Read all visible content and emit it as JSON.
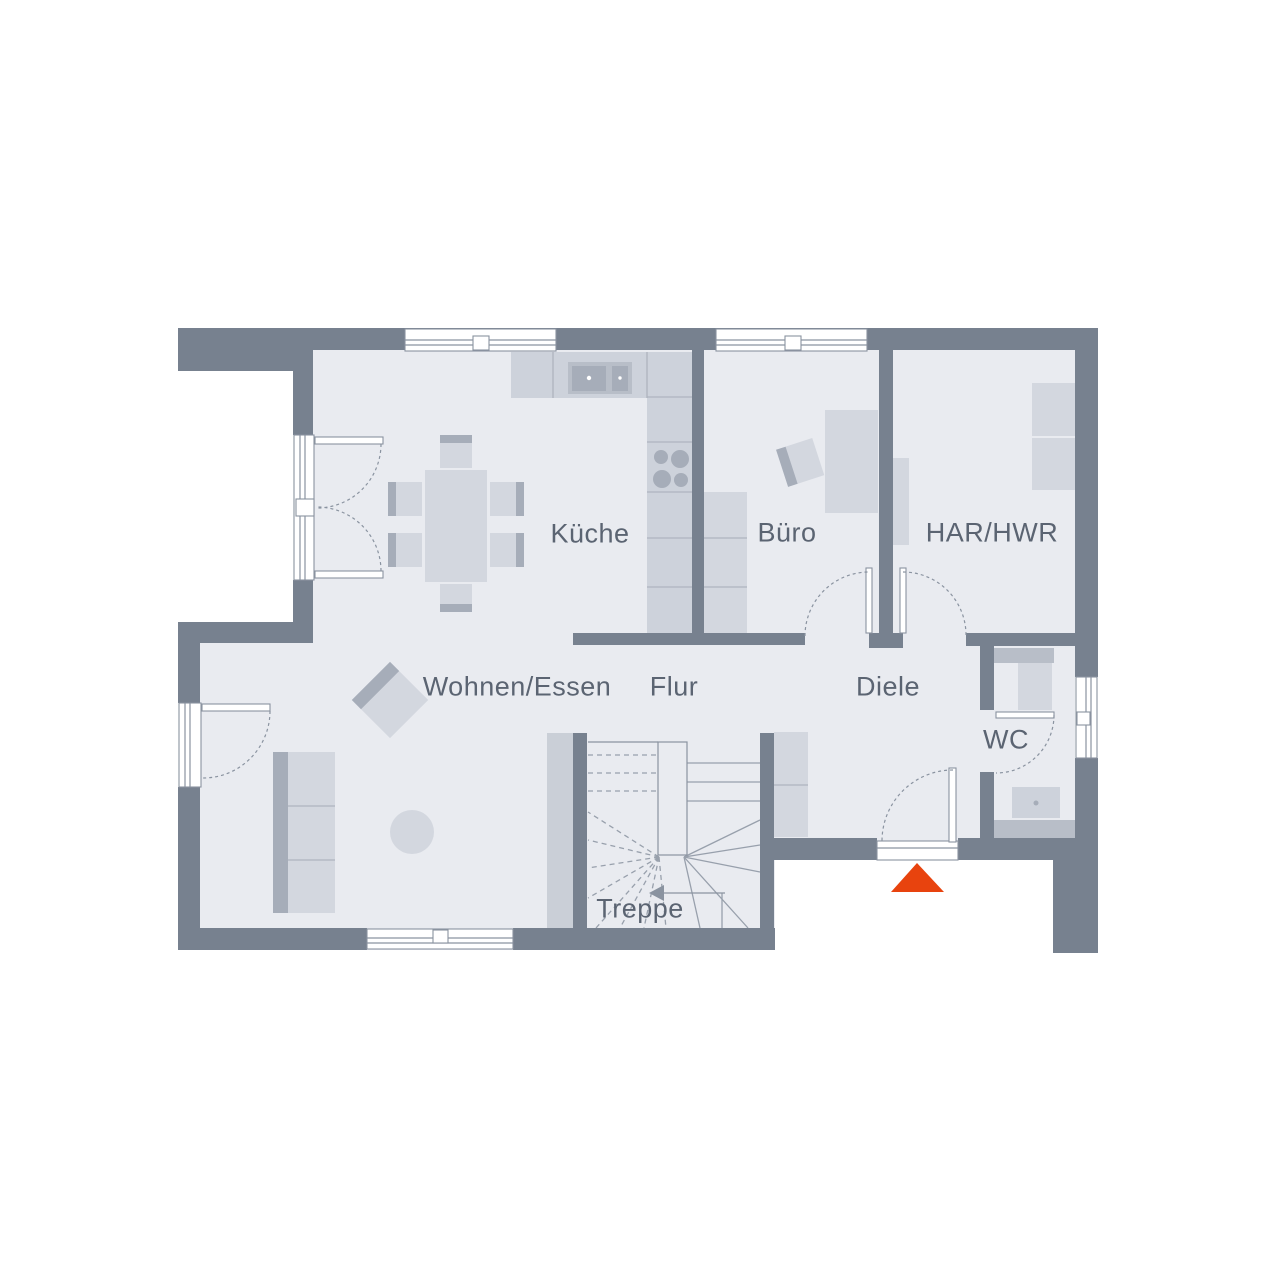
{
  "floorplan": {
    "rooms": [
      {
        "id": "kueche",
        "label": "Küche"
      },
      {
        "id": "buero",
        "label": "Büro"
      },
      {
        "id": "har-hwr",
        "label": "HAR/HWR"
      },
      {
        "id": "wohnen-essen",
        "label": "Wohnen/Essen"
      },
      {
        "id": "flur",
        "label": "Flur"
      },
      {
        "id": "diele",
        "label": "Diele"
      },
      {
        "id": "wc",
        "label": "WC"
      },
      {
        "id": "treppe",
        "label": "Treppe"
      }
    ]
  },
  "colors": {
    "bg": "#FFFFFF",
    "wall": "#77818F",
    "floor": "#E9EBF0",
    "furniture": "#D3D7DF",
    "furniture-alt": "#CDD2DB",
    "accent": "#A6ADB9",
    "medium": "#B8BEC8",
    "strip": "#CACFD7",
    "divider": "#AEB4BF",
    "line": "#8A93A0",
    "tread": "#98A0AC",
    "text": "#5B6472",
    "entrance": "#E8430E"
  }
}
